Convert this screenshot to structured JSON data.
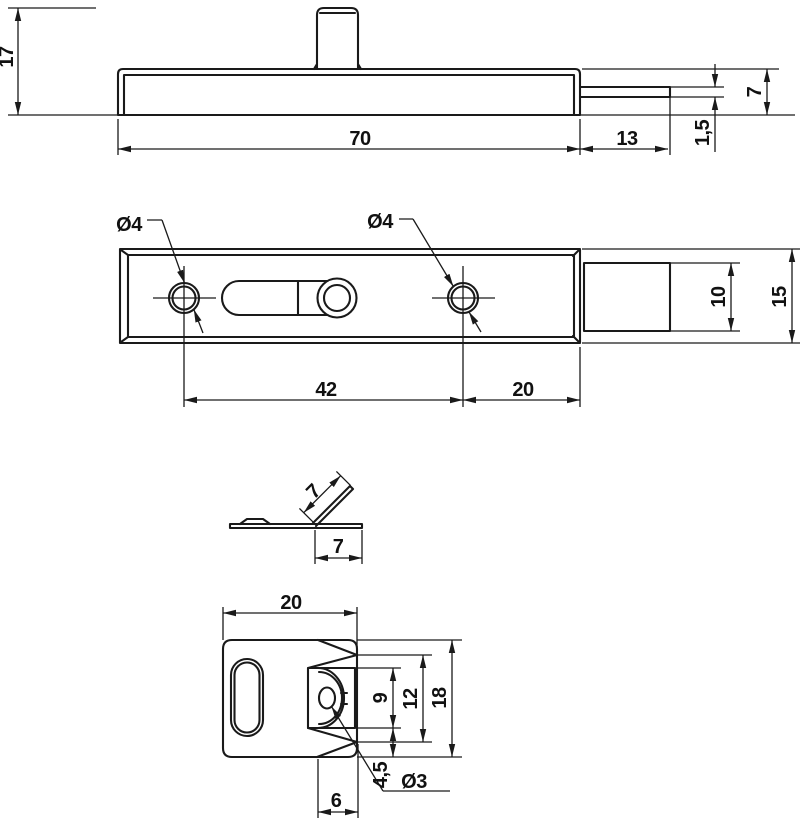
{
  "drawing": {
    "colors": {
      "line": "#1a1a1a",
      "text": "#111111",
      "background": "#ffffff"
    },
    "side_view": {
      "total_height": "17",
      "body_length": "70",
      "bolt_extension": "13",
      "bolt_thickness": "1,5",
      "body_height": "7"
    },
    "plan_view": {
      "hole_label_left": "Ø4",
      "hole_label_right": "Ø4",
      "hole_spacing": "42",
      "hole_to_end": "20",
      "bolt_width": "10",
      "body_width": "15"
    },
    "bracket_side_view": {
      "flap_length": "7",
      "flap_offset": "7"
    },
    "bracket_plan_view": {
      "plate_width": "20",
      "flap_width": "9",
      "cutout_height": "12",
      "plate_height": "18",
      "bottom_offset": "4,5",
      "hole_label": "Ø3",
      "fold_width": "6"
    }
  }
}
